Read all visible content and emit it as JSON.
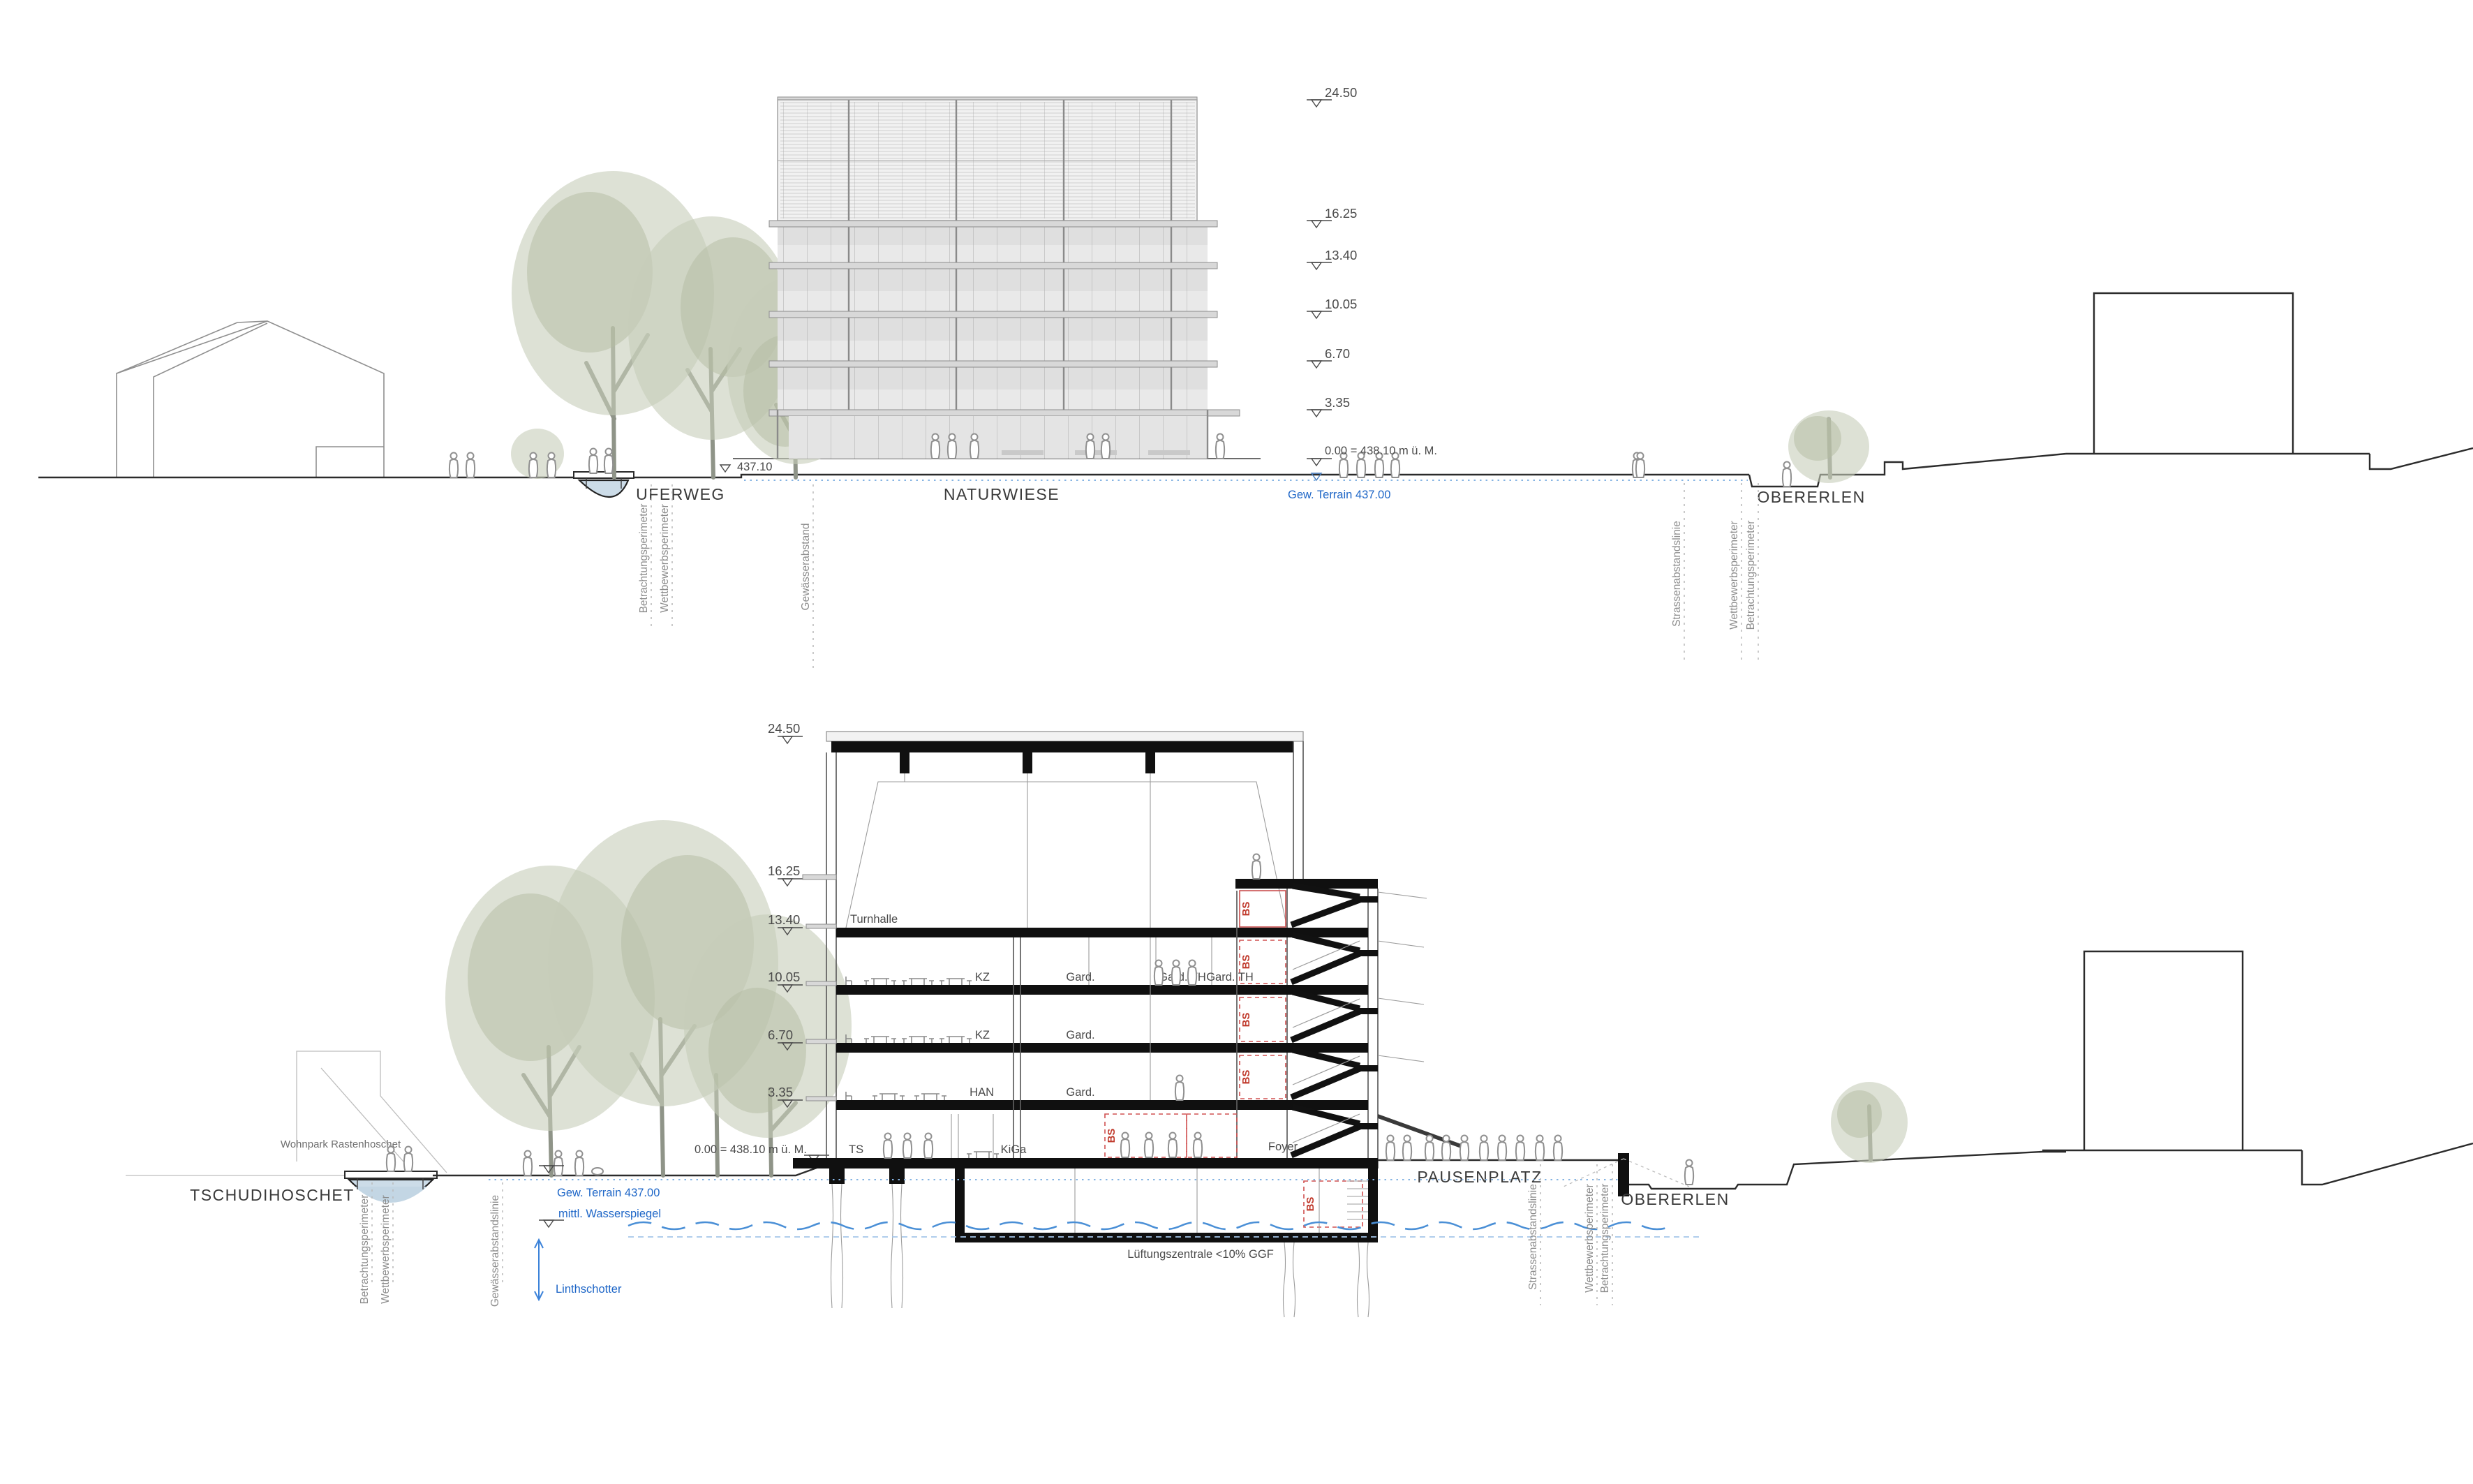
{
  "title": "Wettbewerb Schulhaus – Ansicht und Schnitt",
  "colors": {
    "line": "#2b2b2b",
    "blue_text": "#1e66c7",
    "water_fill": "#ccdce8",
    "water_line": "#4a8fd6",
    "red_bs": "#c0392b",
    "tree": "#c7cdb9",
    "slab": "#d8d8d8"
  },
  "levels": [
    "24.50",
    "16.25",
    "13.40",
    "10.05",
    "6.70",
    "3.35"
  ],
  "zero_label": "0.00 = 438.10 m ü. M.",
  "top_view": {
    "path_marker": "437.10",
    "uferweg": "UFERWEG",
    "naturwiese": "NATURWIESE",
    "obererlen": "OBERERLEN",
    "terrain": "Gew. Terrain 437.00",
    "left_perimeters": [
      "Betrachtungsperimeter",
      "Wettbewerbsperimeter"
    ],
    "water_setback": "Gewässerabstand",
    "right_perimeters": [
      "Strassenabstandslinie",
      "Wettbewerbsperimeter",
      "Betrachtungsperimeter"
    ]
  },
  "section_view": {
    "tschudihoschet": "TSCHUDIHOSCHET",
    "wohnpark": "Wohnpark Rastenhoschet",
    "pausenplatz": "PAUSENPLATZ",
    "obererlen": "OBERERLEN",
    "terrain": "Gew. Terrain 437.00",
    "wasserspiegel": "mittl. Wasserspiegel",
    "linthschotter": "Linthschotter",
    "left_perimeters": [
      "Betrachtungsperimeter",
      "Wettbewerbsperimeter"
    ],
    "water_setback": "Gewässerabstandslinie",
    "right_perimeters": [
      "Strassenabstandslinie",
      "Wettbewerbsperimeter",
      "Betrachtungsperimeter"
    ],
    "rooms": {
      "turnhalle": "Turnhalle",
      "kz": "KZ",
      "gard": "Gard.",
      "gard_th": "Gard. TH",
      "han": "HAN",
      "ts": "TS",
      "kiga": "KiGa",
      "foyer": "Foyer",
      "bs": "BS"
    },
    "basement": "Lüftungszentrale <10% GGF"
  }
}
